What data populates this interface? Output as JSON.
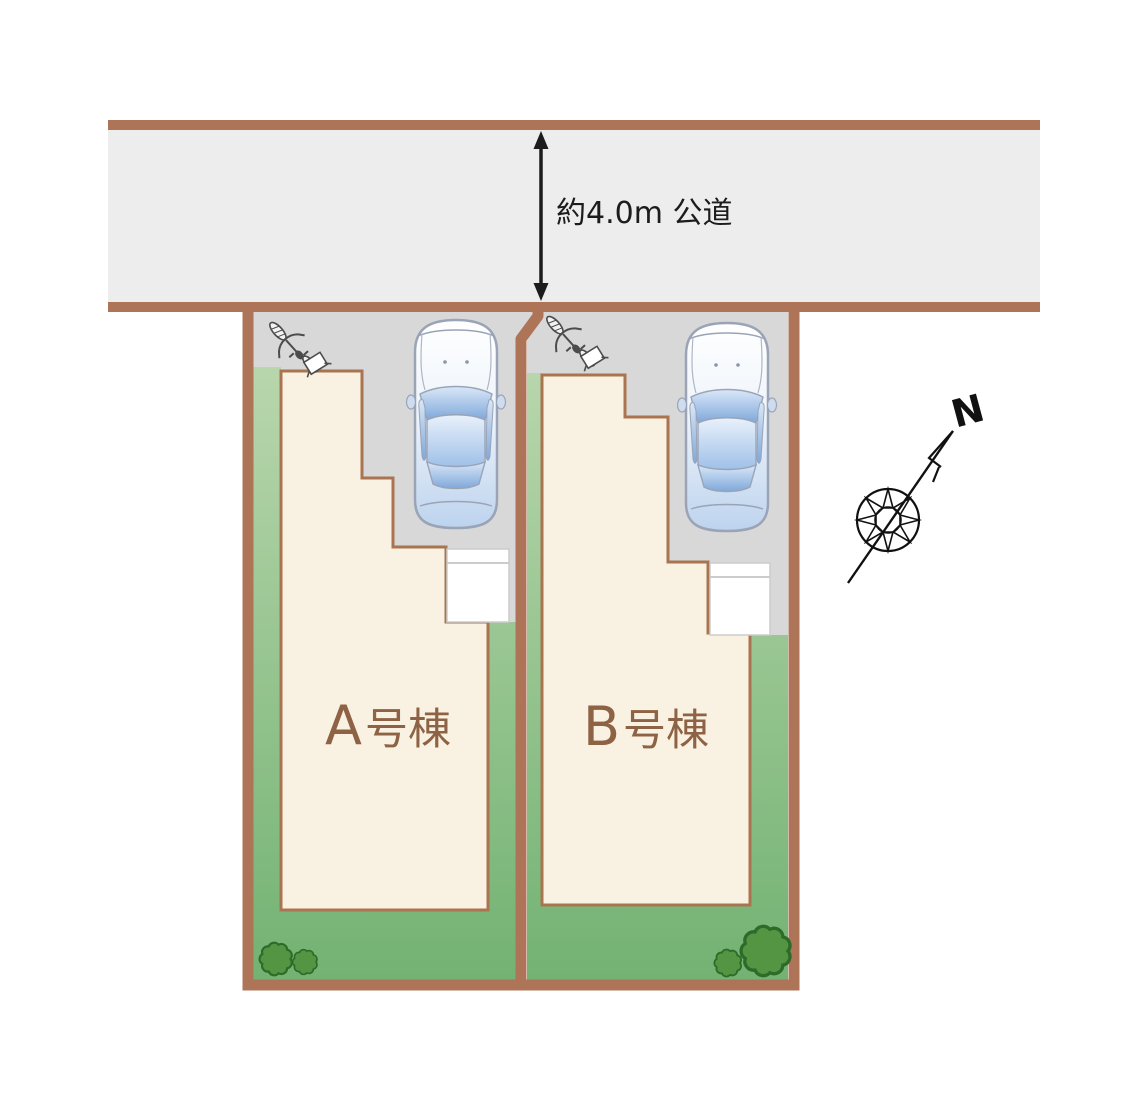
{
  "plan": {
    "road": {
      "width_label": "約4.0m 公道"
    },
    "lots": [
      {
        "id": "A",
        "letter": "A",
        "suffix": "号棟",
        "label": "A号棟"
      },
      {
        "id": "B",
        "letter": "B",
        "suffix": "号棟",
        "label": "B号棟"
      }
    ],
    "compass": {
      "north_label": "N"
    }
  },
  "colors": {
    "border_brown": "#ae7457",
    "road_fill": "#ededed",
    "driveway_gray": "#d8d8d8",
    "building_fill": "#f9f2e2",
    "building_outline": "#a9744f",
    "porch_white": "#ffffff",
    "lawn_light": "#bdd8b0",
    "lawn_dark": "#72b272",
    "label_brown": "#8e6244",
    "bush_green": "#539543",
    "bush_outline": "#2e6b29",
    "ink_black": "#1c1c1c",
    "car_outline": "#9aa4b6"
  },
  "icons": {
    "car": "car-top-view-icon",
    "bicycle": "bicycle-icon",
    "bush": "bush-icon",
    "compass": "compass-rose-icon",
    "north_arrow": "north-arrow-icon",
    "road_width_arrow": "double-arrow-icon"
  }
}
